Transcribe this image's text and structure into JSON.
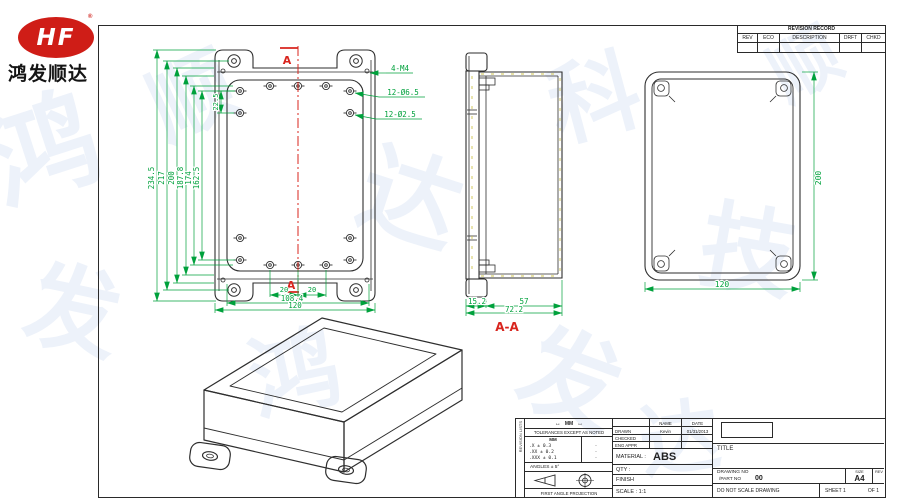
{
  "logo": {
    "monogram": "HF",
    "trademark": "®",
    "company": "鸿发顺达"
  },
  "watermark": {
    "chars": [
      "鸿",
      "发",
      "顺",
      "达",
      "科",
      "技",
      "鸿",
      "发",
      "顺",
      "达"
    ]
  },
  "colors": {
    "dim_green": "#00a13c",
    "section_red": "#d8251e",
    "line": "#2e2e2e",
    "logo_red": "#cf1d17"
  },
  "revision_table": {
    "title": "REVISION RECORD",
    "headers": [
      "REV",
      "ECO",
      "DESCRIPTION",
      "DRFT",
      "CHKD"
    ]
  },
  "front_view": {
    "section_label_top": "A",
    "section_label_bottom": "A",
    "callout_m4": "4-M4",
    "callout_d65": "12-Ø6.5",
    "callout_d25": "12-Ø2.5",
    "dim_234": "234.5",
    "dim_217": "217",
    "dim_200": "200",
    "dim_187": "187.8",
    "dim_174": "174",
    "dim_162": "162.5",
    "dim_22": "22.5",
    "dim_20a": "20",
    "dim_20b": "20",
    "dim_108": "108.4",
    "dim_120": "120"
  },
  "section_view": {
    "label": "A-A",
    "dim_152": "15.2",
    "dim_57": "57",
    "dim_722": "72.2"
  },
  "side_view": {
    "dim_200": "200",
    "dim_120": "120"
  },
  "title_block": {
    "side_strip": "REVISION LISTS",
    "units_glyph": "↔",
    "units": "MM",
    "tolerances_title": "TOLERANCES EXCEPT AS NOTED",
    "tol_unit_header": "MM",
    "tol_rows": [
      ".X ± 0.3",
      ".XX ± 0.2",
      ".XXX ± 0.1"
    ],
    "tol_inch_marks": [
      "·",
      "·",
      "·"
    ],
    "angles": "ANGLES ± 5°",
    "first_angle": "FIRST ANGLE PROJECTION",
    "name_header": "NAME",
    "date_header": "DATE",
    "drawn_label": "DRAWN",
    "drawn_name": "Kevin",
    "drawn_date": "01/31/2013",
    "checked_label": "CHECKED",
    "eng_label": "ENG APPR",
    "material_label": "MATERIAL :",
    "material_value": "ABS",
    "qty_label": "QTY :",
    "finish_label": "FINISH",
    "scale_label": "SCALE : 1:1",
    "title_label": "TITLE",
    "drawing_no_label": "DRAWING NO",
    "part_no_label": "/PART NO",
    "part_no_value": "00",
    "size_label": "SIZE",
    "size_value": "A4",
    "rev_label": "REV",
    "do_not_scale": "DO NOT SCALE DRAWING",
    "sheet_label": "SHEET 1",
    "of_label": "OF 1"
  }
}
